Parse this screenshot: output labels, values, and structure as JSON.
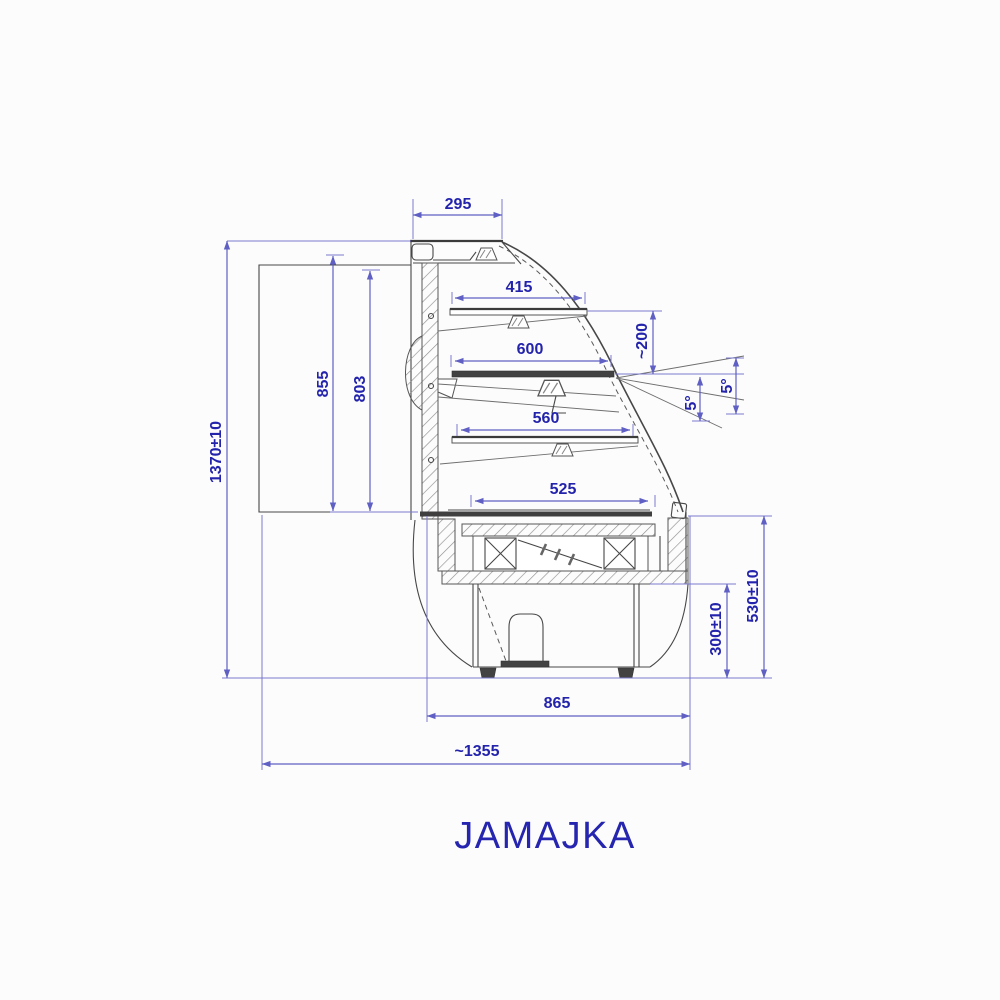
{
  "title": "JAMAJKA",
  "colors": {
    "dimension_text": "#2323ac",
    "dimension_line": "#5f5fc4",
    "drawing_line": "#474747",
    "background": "#fcfcfc"
  },
  "dims": {
    "d295": "295",
    "d415": "415",
    "d200": "~200",
    "d600": "600",
    "d5a": "5°",
    "d5b": "5°",
    "d560": "560",
    "d525": "525",
    "d855": "855",
    "d803": "803",
    "d1370": "1370±10",
    "d300": "300±10",
    "d530": "530±10",
    "d865": "865",
    "d1355": "~1355"
  }
}
